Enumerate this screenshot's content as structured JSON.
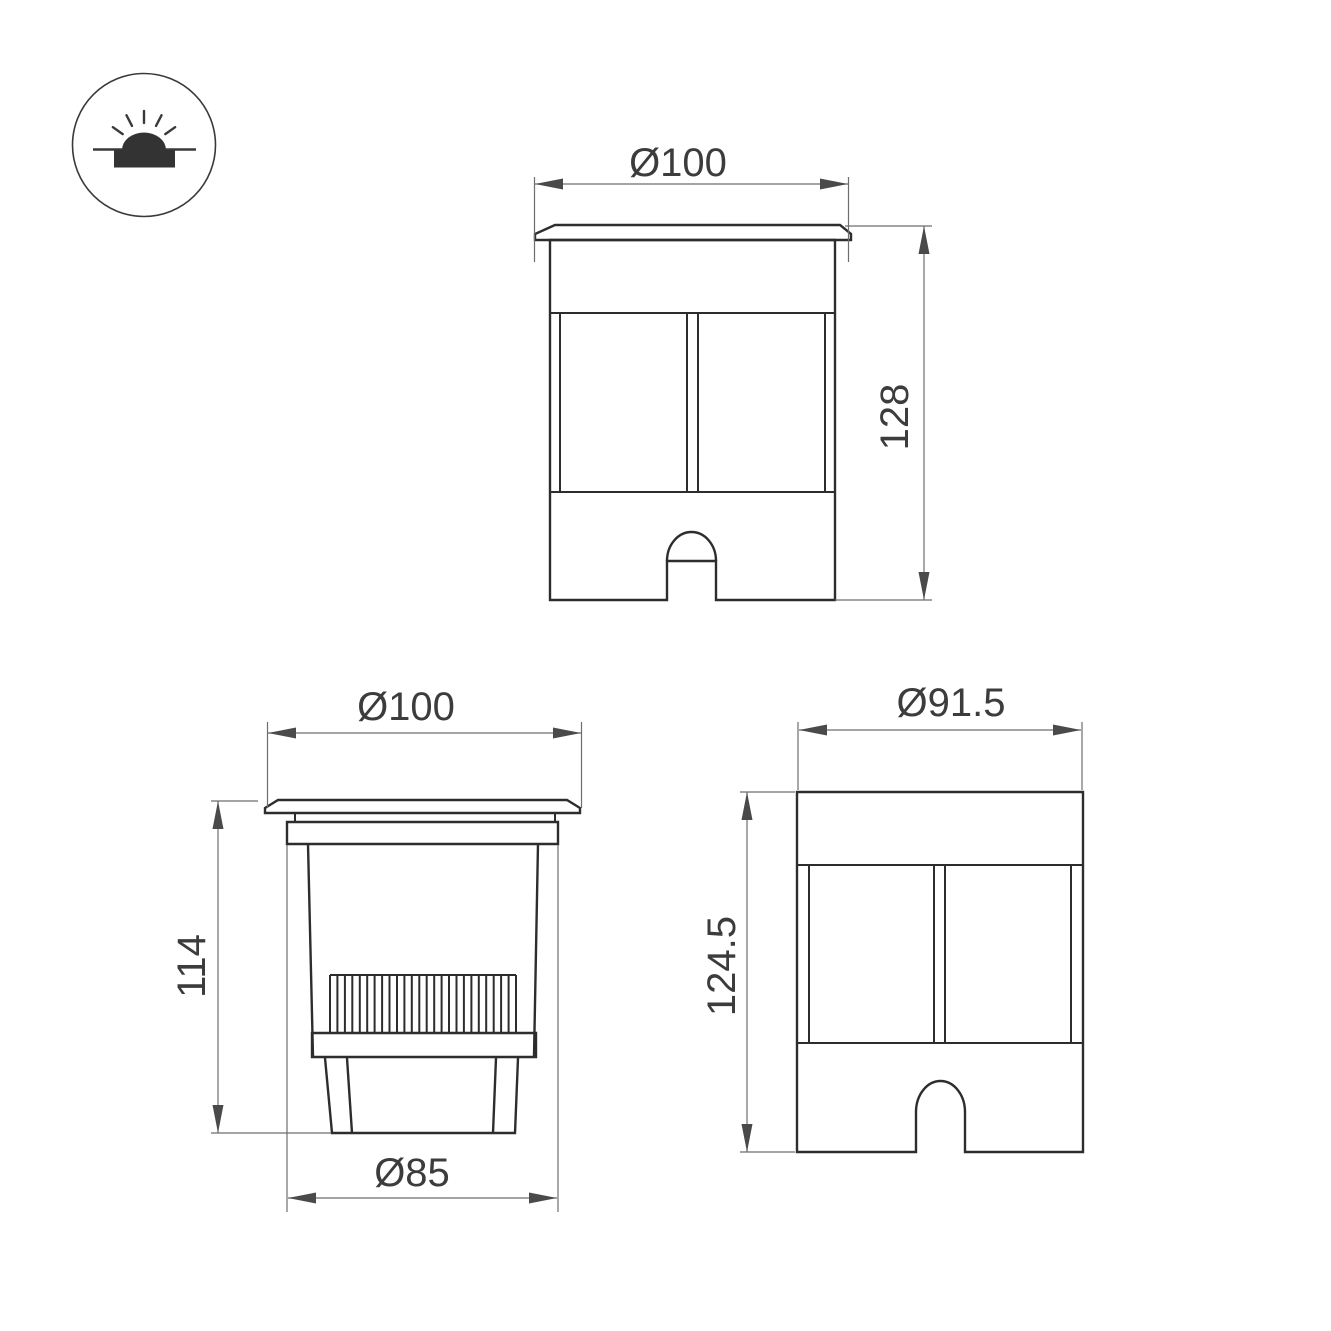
{
  "page": {
    "background": "#ffffff",
    "kind": "technical-dimension-drawing"
  },
  "icon": {
    "meaning": "recessed-in-ground-luminaire"
  },
  "views": {
    "front": {
      "diameter": "Ø100",
      "height": "128"
    },
    "section": {
      "diameter": "Ø100",
      "height": "114",
      "base_diameter": "Ø85"
    },
    "side": {
      "diameter": "Ø91.5",
      "height": "124.5"
    }
  },
  "colors": {
    "outline": "#2d2d2d",
    "dimension_line": "#6e6e6e",
    "arrowhead": "#4a4a4a",
    "text": "#3c3c3c",
    "background": "#ffffff"
  }
}
